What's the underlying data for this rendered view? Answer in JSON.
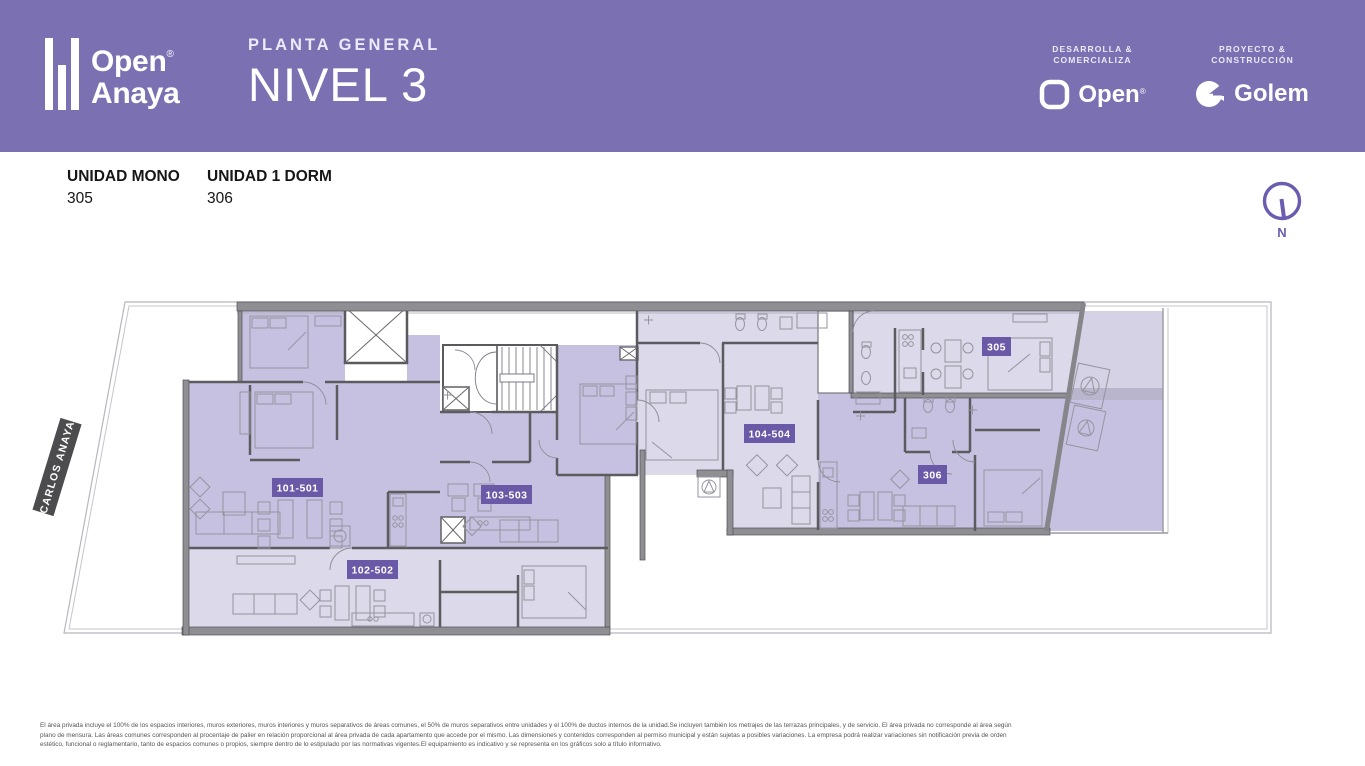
{
  "header": {
    "brand": {
      "word1": "Open",
      "word2": "Anaya",
      "registered": "®"
    },
    "plan_type": "PLANTA GENERAL",
    "level": "NIVEL 3",
    "developer": {
      "role_line1": "DESARROLLA &",
      "role_line2": "COMERCIALIZA",
      "name": "Open",
      "registered": "®"
    },
    "builder": {
      "role_line1": "PROYECTO &",
      "role_line2": "CONSTRUCCIÓN",
      "name": "Golem"
    }
  },
  "legend": {
    "units": [
      {
        "type": "UNIDAD MONO",
        "number": "305"
      },
      {
        "type": "UNIDAD 1 DORM",
        "number": "306"
      }
    ]
  },
  "compass": {
    "label": "N"
  },
  "plan": {
    "street_label": "CARLOS ANAYA",
    "labels": {
      "l101": "101-501",
      "l102": "102-502",
      "l103": "103-503",
      "l104": "104-504",
      "l305": "305",
      "l306": "306"
    }
  },
  "colors": {
    "header_bg": "#7b70b2",
    "accent_purple": "#6a59a6",
    "compass_purple": "#6c5cb0",
    "unit_fill_dark": "#c7c1e1",
    "unit_fill_light": "#dcd9ea",
    "wall_gray": "#8f8f93",
    "street_badge": "#4c4c4e"
  },
  "disclaimer": {
    "line1": "El área privada incluye el 100% de los espacios interiores, muros exteriores, muros interiores y muros separativos de áreas comunes, el 50% de muros separativos entre unidades y el 100% de ductos internos de la unidad.Se incluyen también los metrajes de las terrazas principales, y de servicio. El área privada no corresponde al área según",
    "line2": "plano de mensura. Las áreas comunes corresponden al procentaje de palier en relación proporcional al área privada de cada apartamento que accede por el mismo. Las dimensiones y contenidos corresponden al permiso municipal y están sujetas a posibles variaciones. La empresa podrá realizar variaciones sin notificación previa de orden",
    "line3": "estético, funcional o reglamentario, tanto de espacios comunes o propios, siempre dentro de lo estipulado por las normativas vigentes.El equipamiento es indicativo y se representa en los gráficos solo a título informativo."
  }
}
